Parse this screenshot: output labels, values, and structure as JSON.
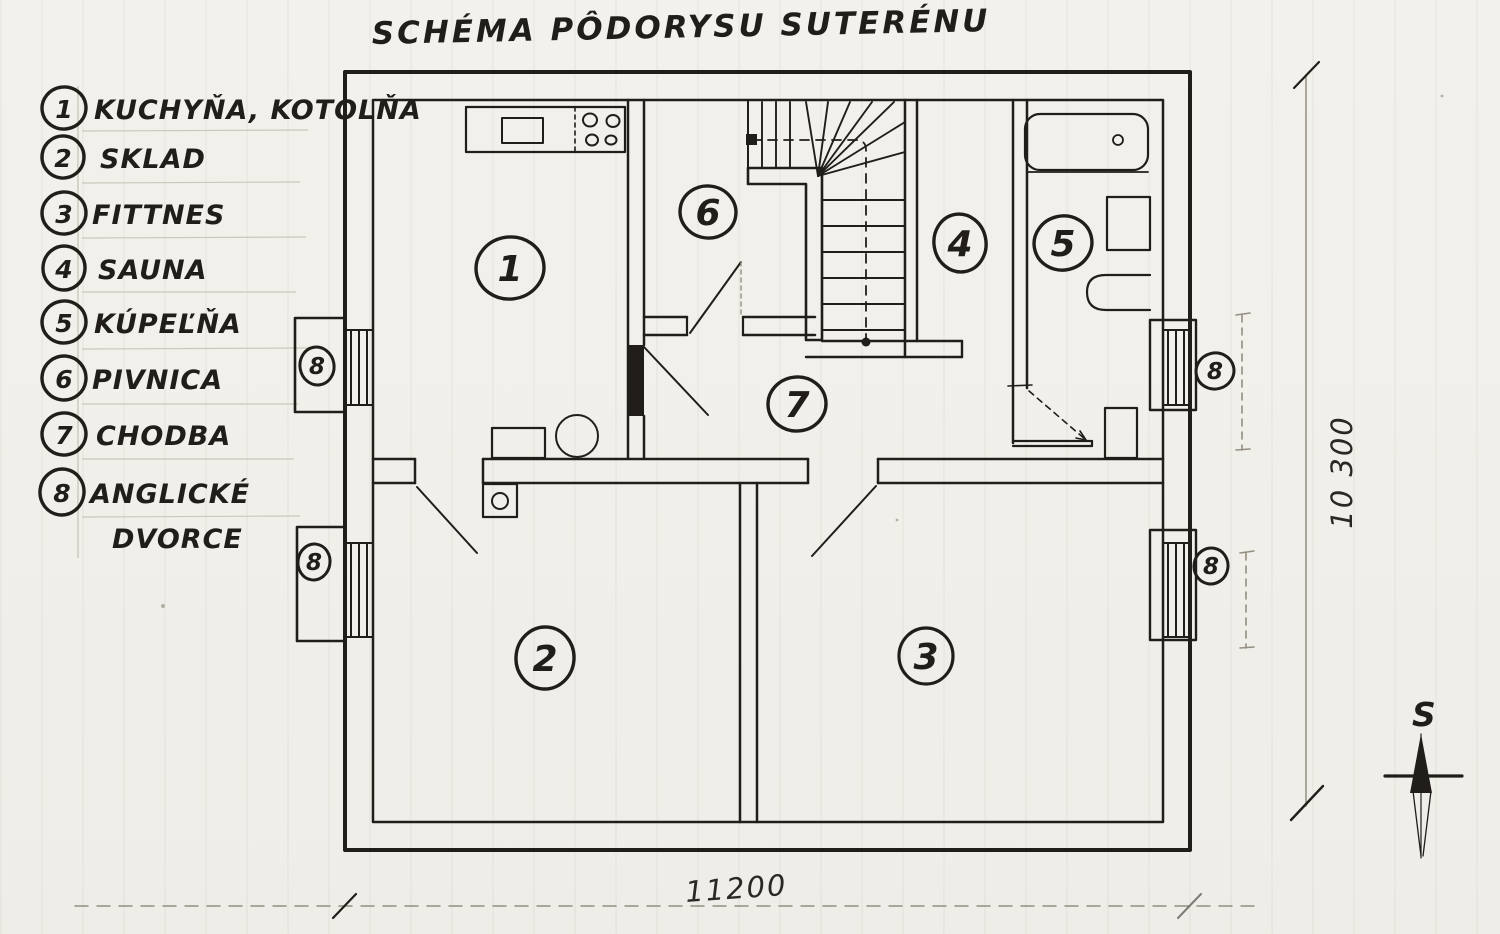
{
  "title": "SCHÉMA PÔDORYSU SUTERÉNU",
  "legend": {
    "items": [
      {
        "num": "1",
        "label": "KUCHYŇA, KOTOLŇA",
        "label2": ""
      },
      {
        "num": "2",
        "label": "SKLAD",
        "label2": ""
      },
      {
        "num": "3",
        "label": "FITTNES",
        "label2": ""
      },
      {
        "num": "4",
        "label": "SAUNA",
        "label2": ""
      },
      {
        "num": "5",
        "label": "KÚPEĽŇA",
        "label2": ""
      },
      {
        "num": "6",
        "label": "PIVNICA",
        "label2": ""
      },
      {
        "num": "7",
        "label": "CHODBA",
        "label2": ""
      },
      {
        "num": "8",
        "label": "ANGLICKÉ",
        "label2": "DVORCE"
      }
    ]
  },
  "plan": {
    "room_markers": [
      {
        "num": "1"
      },
      {
        "num": "2"
      },
      {
        "num": "3"
      },
      {
        "num": "4"
      },
      {
        "num": "5"
      },
      {
        "num": "6"
      },
      {
        "num": "7"
      }
    ],
    "well_markers": [
      {
        "num": "8"
      },
      {
        "num": "8"
      },
      {
        "num": "8"
      },
      {
        "num": "8"
      }
    ]
  },
  "dimensions": {
    "bottom": "11200",
    "right": "10 300"
  },
  "compass": {
    "label": "S"
  },
  "colors": {
    "ink": "#211e1a",
    "paper": "#f2f0ea"
  }
}
